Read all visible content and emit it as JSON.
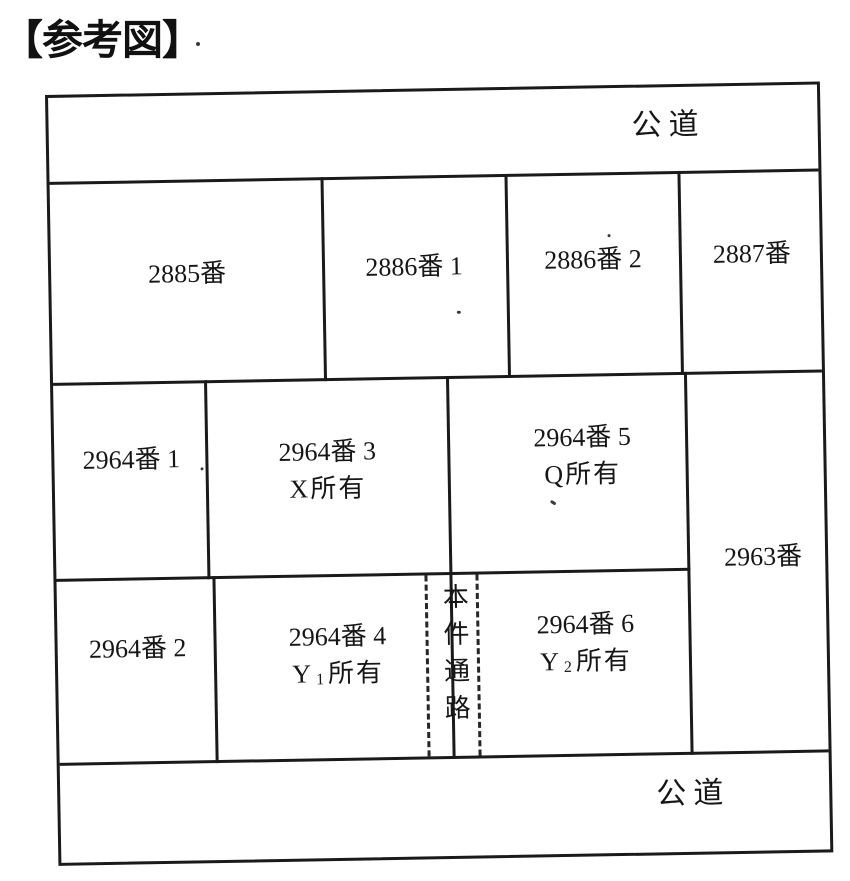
{
  "page_title": "【参考図】",
  "colors": {
    "ink": "#1a1a1a",
    "paper": "#ffffff"
  },
  "roads": {
    "top": "公道",
    "bottom": "公道"
  },
  "parcels": {
    "p2885": "2885番",
    "p2886_1": "2886番 1",
    "p2886_2": "2886番 2",
    "p2887": "2887番",
    "p2963": "2963番",
    "p2964_1": "2964番 1",
    "p2964_2": "2964番 2",
    "p2964_3": {
      "number": "2964番 3",
      "owner": "X",
      "suffix": "所有"
    },
    "p2964_4": {
      "number": "2964番 4",
      "owner": "Y",
      "sub": "1",
      "suffix": "所有"
    },
    "p2964_5": {
      "number": "2964番 5",
      "owner": "Q",
      "suffix": "所有"
    },
    "p2964_6": {
      "number": "2964番 6",
      "owner": "Y",
      "sub": "2",
      "suffix": "所有"
    }
  },
  "passage_label": "本件通路"
}
